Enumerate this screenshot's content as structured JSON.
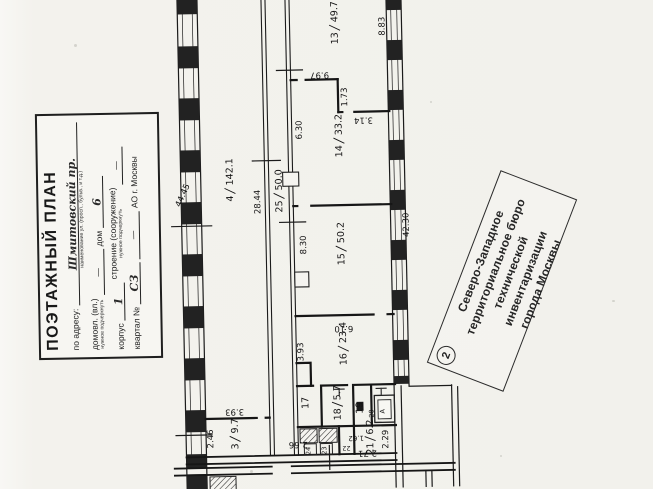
{
  "page": {
    "floor_num": "1",
    "floor_word": "ЭТАЖ"
  },
  "stamp_box": {
    "title": "ПОЭТАЖНЫЙ ПЛАН",
    "address_label": "по адресу:",
    "address_value": "Шмитовский пр.",
    "address_sub": "наименование ул. (просп., бульв., и т.д.)",
    "domovl_label": "домовл. (вл.)",
    "domovl_sub": "нужное подчеркнуть",
    "domovl_value": "—",
    "dom_label": "дом",
    "dom_value": "6",
    "korpus_label": "корпус",
    "korpus_value": "1",
    "stroenie_label": "строение (сооружение)",
    "stroenie_sub": "нужное подчеркнуть",
    "stroenie_value": "—",
    "kvartal_label": "квартал №",
    "kvartal_value": "СЗ",
    "dash": "—",
    "okrug_label": "АО г. Москвы"
  },
  "bti_stamp": {
    "number": "2",
    "line1": "Северо-Западное",
    "line2": "территориальное бюро",
    "line3": "технической инвентаризации",
    "line4": "города Москвы"
  },
  "plan": {
    "rooms": {
      "r3": {
        "num": "3",
        "area": "9.7"
      },
      "r4": {
        "num": "4",
        "area": "142.1"
      },
      "r13": {
        "num": "13",
        "area": "49.7"
      },
      "r14": {
        "num": "14",
        "area": "33.2"
      },
      "r15": {
        "num": "15",
        "area": "50.2"
      },
      "r16": {
        "num": "16",
        "area": "23.4"
      },
      "r17": {
        "num": "17"
      },
      "r18": {
        "num": "18",
        "area": "5.7"
      },
      "r19": {
        "num": "19"
      },
      "r20": {
        "num": "20"
      },
      "r21": {
        "num": "21",
        "area": "6.2"
      },
      "r22": {
        "num": "22"
      },
      "r23": {
        "num": "23"
      },
      "r24": {
        "num": "24"
      },
      "r25": {
        "num": "25",
        "area": "50.0"
      }
    },
    "dims": {
      "top_right": "8.83",
      "w13": "9.97",
      "n13a": "1.73",
      "n13b": "3.14",
      "h14": "6.30",
      "len_left": "44.45",
      "len_mid": "28.44",
      "len_right": "42.30",
      "h15": "8.30",
      "w15": "6.10",
      "h16": "3.93",
      "w3": "3.93",
      "h3": "2.46",
      "w_corr": "2.66",
      "w21": "2.71",
      "h21": "2.29",
      "w19": "1.62"
    },
    "bath_letter": "А"
  }
}
